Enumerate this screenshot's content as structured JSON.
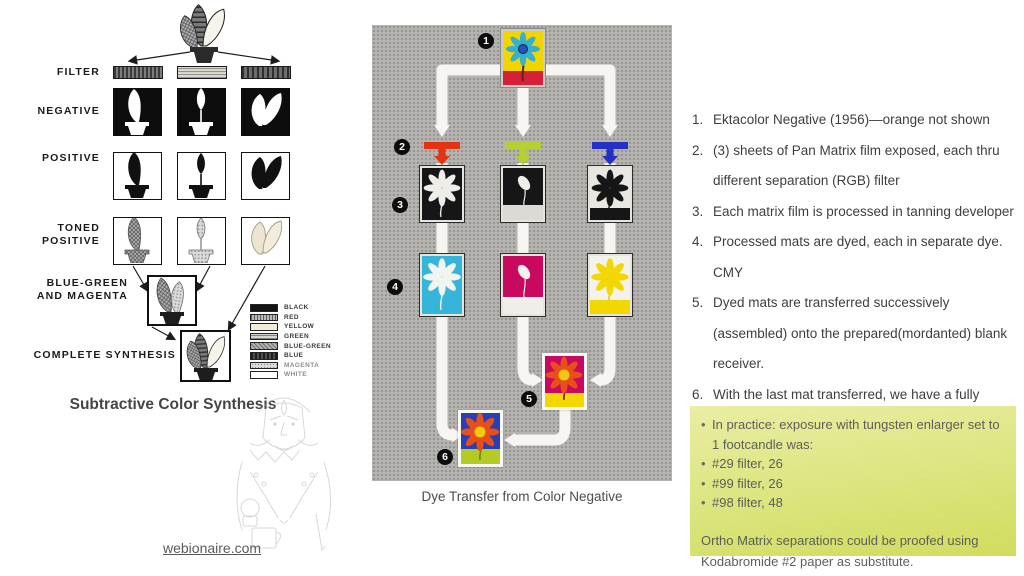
{
  "left_panel": {
    "caption": "Subtractive Color Synthesis",
    "labels": {
      "filter": "FILTER",
      "negative": "NEGATIVE",
      "positive": "POSITIVE",
      "toned_positive": "TONED\nPOSITIVE",
      "blue_green_magenta": "BLUE-GREEN\nAND MAGENTA",
      "complete_synthesis": "COMPLETE SYNTHESIS"
    },
    "legend": [
      "BLACK",
      "RED",
      "YELLOW",
      "GREEN",
      "BLUE-GREEN",
      "BLUE",
      "MAGENTA",
      "WHITE"
    ],
    "watermark": "webionaire.com"
  },
  "middle_panel": {
    "caption": "Dye Transfer from Color Negative",
    "badges": [
      "1",
      "2",
      "3",
      "4",
      "5",
      "6"
    ],
    "colors": {
      "panel_bg": "#b5b3b0",
      "filter_red": "#e33312",
      "filter_green": "#b5d030",
      "filter_blue": "#2531c4",
      "cyan_dye": "#35b5d9",
      "magenta_dye": "#c9095f",
      "yellow_dye": "#f2d800",
      "final_blue": "#2b3fb5",
      "final_green": "#b5cb25",
      "flower_orange": "#e85018"
    }
  },
  "steps_list": [
    {
      "num": "1.",
      "text": "Ektacolor Negative (1956)—orange not shown"
    },
    {
      "num": "2.",
      "text": "(3) sheets of Pan Matrix film exposed, each thru different separation (RGB) filter"
    },
    {
      "num": "3.",
      "text": "Each matrix film is processed in tanning developer"
    },
    {
      "num": "4.",
      "text": "Processed mats are dyed, each in separate dye. CMY"
    },
    {
      "num": "5.",
      "text": "Dyed mats are transferred successively (assembled) onto the prepared(mordanted) blank receiver."
    },
    {
      "num": "6.",
      "text": "With the last mat transferred, we have a fully assembled color print"
    }
  ],
  "note": {
    "bullet_glyph": "•",
    "bullets": [
      "In practice: exposure with tungsten enlarger set to 1 footcandle was:",
      "#29 filter, 26",
      "#99 filter, 26",
      "#98 filter, 48"
    ],
    "footer": "Ortho Matrix separations could be proofed using Kodabromide #2 paper as substitute.",
    "bg_top": "#eaeda3",
    "bg_bottom": "#d1dc5e"
  }
}
